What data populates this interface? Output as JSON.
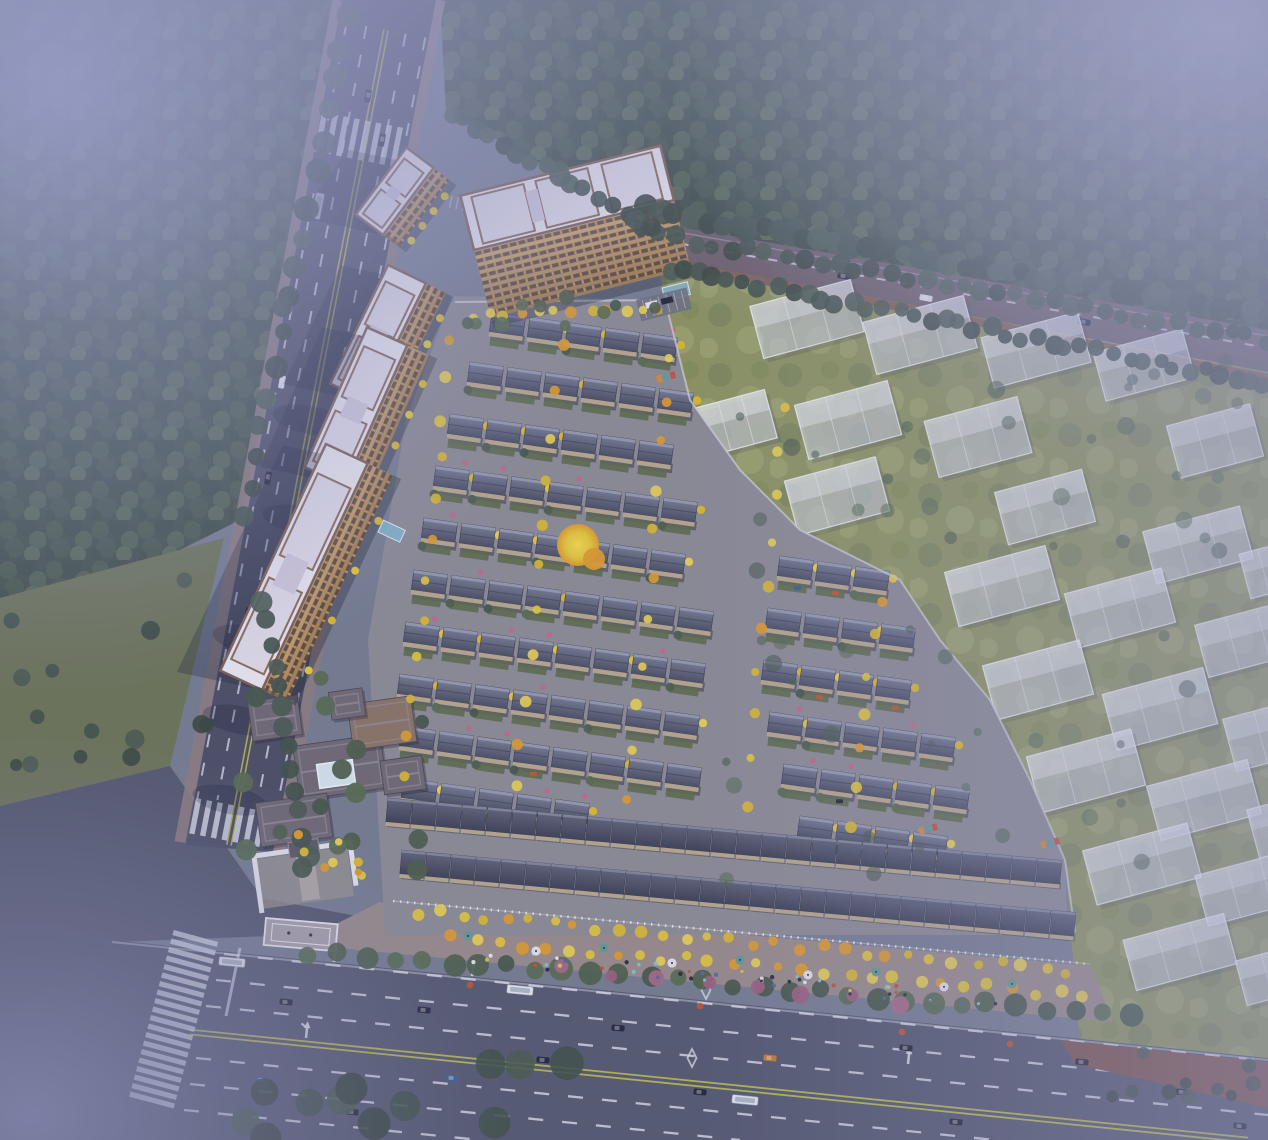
{
  "scene": {
    "type": "aerial-architectural-rendering",
    "description": "Dusk aerial rendering of a residential community: tan high-rise slabs along a western road, dark-roofed courtyard townhouse rows in the center, translucent future-phase villas on an eastern meadow, fog-covered forest, and a wide south boulevard with a shop-lined entrance promenade.",
    "canvas": {
      "width": 1268,
      "height": 1140
    },
    "palette": {
      "base": "#757c90",
      "haze_tl": "#9ba0c8",
      "haze_tr": "#a9adcf",
      "haze_bl": "#8488ad",
      "haze_r": "#9a9ec4",
      "tint": "#6d74a8",
      "forest_bg": "#3f4c44",
      "forest_1": "#475848",
      "forest_2": "#3a4a42",
      "forest_3": "#4e5f4e",
      "forest_4": "#435447",
      "forest_5": "#556653",
      "meadow_bg": "#8d935f",
      "meadow_1": "#7e885a",
      "meadow_2": "#99a06a",
      "meadow_3": "#848e57",
      "lawn": "#6b7356",
      "plaza": "#53566c",
      "asphalt_w": "#4b4e64",
      "asphalt_s": "#54586f",
      "asphalt_n": "#6b5e68",
      "lane_white": "#d6d9e6",
      "lane_yellow": "#b9b94f",
      "sidewalk": "#8d7b7e",
      "sidewalk_warm": "#978a8a",
      "median_brown": "#7b5450",
      "villa_roof_hi": "#777c93",
      "villa_roof_lo": "#4a4e63",
      "villa_ridge": "#959ab0",
      "villa_wall": "#b7a68b",
      "garden": "#5c6a4b",
      "shop_roof_hi": "#60647a",
      "shop_roof_lo": "#3d4155",
      "shop_ridge": "#80859a",
      "path": "#8b8a94",
      "tower_roof": "#e9e7f0",
      "tower_panel": "#dfdbe8",
      "tower_trim": "#7c5f53",
      "tower_wall_hi": "#d0a873",
      "tower_wall_lo": "#9c7950",
      "window_dark": "#4a3c35",
      "window_mullion": "#bb9161",
      "ghost_fill": "rgba(226,230,242,0.52)",
      "ghost_line": "rgba(244,246,252,0.8)",
      "ghost_roof": "rgba(250,251,255,0.35)",
      "club_roof": "#6e6874",
      "club_roof_warm": "#8a7366",
      "club_ridge": "#908b96",
      "skylight": "#d3e2ec",
      "white_wall": "#e6e6ec",
      "ginkgo": "#e2c63b",
      "ginkgo_2": "#d9b82f",
      "ginkgo_3": "#e7cf52",
      "ginkgo_orange": "#dd9b2d",
      "tree_g1": "#4d5e4c",
      "tree_g2": "#576a51",
      "tree_g3": "#45564a",
      "tree_d1": "#41514a",
      "tree_d2": "#38463f",
      "tree_d3": "#4a5a50",
      "blossom": "#a66a88",
      "flower_pink": "#c96487",
      "flower_red": "#c05532",
      "umbrella": "#5e9b97",
      "glass": "#82b4c9",
      "car_dark": "#23263a",
      "car_white": "#e3e5ee",
      "car_blue": "#3c5f92",
      "car_orange": "#c27a2e",
      "shadow": "rgba(28,32,56,0.3)"
    },
    "forest_nw": [
      [
        0,
        0
      ],
      [
        346,
        0
      ],
      [
        288,
        300
      ],
      [
        240,
        520
      ],
      [
        0,
        640
      ]
    ],
    "forest_ne": [
      [
        440,
        0
      ],
      [
        1268,
        0
      ],
      [
        1268,
        332
      ],
      [
        658,
        228
      ],
      [
        446,
        112
      ]
    ],
    "lawn_west": [
      [
        0,
        598
      ],
      [
        224,
        538
      ],
      [
        170,
        766
      ],
      [
        0,
        806
      ]
    ],
    "meadow_east": [
      [
        655,
        250
      ],
      [
        1268,
        360
      ],
      [
        1268,
        1062
      ],
      [
        1080,
        1044
      ],
      [
        1065,
        860
      ],
      [
        1030,
        780
      ],
      [
        990,
        700
      ],
      [
        940,
        640
      ],
      [
        900,
        580
      ],
      [
        800,
        530
      ],
      [
        740,
        470
      ],
      [
        690,
        400
      ],
      [
        665,
        300
      ]
    ],
    "plaza": [
      [
        0,
        806
      ],
      [
        170,
        766
      ],
      [
        262,
        898
      ],
      [
        430,
        930
      ],
      [
        114,
        942
      ],
      [
        0,
        1016
      ]
    ],
    "villa_ground": [
      [
        452,
        296
      ],
      [
        665,
        300
      ],
      [
        690,
        400
      ],
      [
        740,
        470
      ],
      [
        800,
        530
      ],
      [
        900,
        580
      ],
      [
        940,
        640
      ],
      [
        990,
        700
      ],
      [
        1030,
        780
      ],
      [
        1065,
        860
      ],
      [
        1068,
        935
      ],
      [
        385,
        935
      ],
      [
        368,
        640
      ],
      [
        406,
        420
      ]
    ],
    "sidewalk_south": [
      [
        380,
        902
      ],
      [
        1092,
        966
      ],
      [
        1112,
        1022
      ],
      [
        296,
        944
      ]
    ],
    "median_verge": [
      [
        1060,
        1040
      ],
      [
        1268,
        1062
      ],
      [
        1268,
        1108
      ],
      [
        1075,
        1064
      ]
    ],
    "road_west_poly": [
      [
        342,
        0
      ],
      [
        436,
        0
      ],
      [
        273,
        852
      ],
      [
        186,
        845
      ]
    ],
    "road_west_center": [
      386,
      30,
      229,
      845
    ],
    "road_north_poly": [
      [
        652,
        222
      ],
      [
        1268,
        330
      ],
      [
        1268,
        372
      ],
      [
        662,
        258
      ]
    ],
    "road_south_poly": [
      [
        112,
        940
      ],
      [
        1268,
        1058
      ],
      [
        1268,
        1140
      ],
      [
        0,
        1140
      ],
      [
        0,
        1016
      ]
    ],
    "yellow_line_south": [
      190,
      1032,
      1248,
      1140
    ],
    "boundary_wall": [
      [
        455,
        302
      ],
      [
        665,
        300
      ],
      [
        690,
        400
      ],
      [
        740,
        470
      ],
      [
        800,
        530
      ],
      [
        900,
        580
      ],
      [
        940,
        640
      ],
      [
        990,
        700
      ],
      [
        1030,
        780
      ],
      [
        1065,
        860
      ],
      [
        1075,
        932
      ]
    ],
    "towers": [
      [
        383,
        235,
        84,
        34,
        20,
        -53
      ],
      [
        368,
        402,
        132,
        42,
        22,
        -64
      ],
      [
        345,
        485,
        153,
        44,
        24,
        -66
      ],
      [
        262,
        690,
        250,
        46,
        28,
        -65
      ]
    ],
    "slab": {
      "x": 474,
      "y": 250,
      "len": 206,
      "w": 56,
      "fw": 70,
      "rot": -14
    },
    "villa_rows": [
      [
        492,
        312,
        5
      ],
      [
        470,
        362,
        6
      ],
      [
        450,
        414,
        6
      ],
      [
        436,
        466,
        7
      ],
      [
        424,
        518,
        7
      ],
      [
        414,
        570,
        8
      ],
      [
        406,
        622,
        8
      ],
      [
        400,
        674,
        8
      ],
      [
        402,
        726,
        8
      ],
      [
        404,
        778,
        5
      ]
    ],
    "annex_rows": [
      [
        780,
        556,
        3
      ],
      [
        768,
        608,
        4
      ],
      [
        764,
        660,
        4
      ],
      [
        770,
        712,
        5
      ],
      [
        784,
        764,
        5
      ],
      [
        800,
        816,
        4
      ]
    ],
    "shop_bands": [
      [
        388,
        798,
        27
      ],
      [
        402,
        850,
        27
      ]
    ],
    "ghost_blocks": [
      [
        755,
        292,
        104,
        54
      ],
      [
        868,
        308,
        104,
        54
      ],
      [
        986,
        324,
        100,
        52
      ],
      [
        1098,
        340,
        92,
        50
      ],
      [
        700,
        398,
        72,
        50
      ],
      [
        800,
        392,
        96,
        56
      ],
      [
        930,
        408,
        96,
        58
      ],
      [
        1172,
        414,
        86,
        54
      ],
      [
        790,
        468,
        94,
        56
      ],
      [
        1000,
        480,
        90,
        54
      ],
      [
        1148,
        518,
        100,
        54
      ],
      [
        1244,
        546,
        58,
        46
      ],
      [
        950,
        558,
        104,
        56
      ],
      [
        1070,
        580,
        100,
        56
      ],
      [
        1200,
        612,
        96,
        54
      ],
      [
        988,
        652,
        100,
        56
      ],
      [
        1108,
        680,
        104,
        58
      ],
      [
        1228,
        706,
        96,
        54
      ],
      [
        1032,
        742,
        108,
        58
      ],
      [
        1152,
        772,
        104,
        56
      ],
      [
        1252,
        800,
        70,
        50
      ],
      [
        1088,
        836,
        108,
        56
      ],
      [
        1200,
        862,
        100,
        52
      ],
      [
        1128,
        926,
        104,
        52
      ],
      [
        1240,
        950,
        80,
        46
      ]
    ],
    "club_roofs": [
      [
        296,
        740,
        88,
        54,
        "club_roof"
      ],
      [
        250,
        698,
        50,
        40,
        "club_roof"
      ],
      [
        350,
        700,
        64,
        46,
        "club_roof_warm"
      ],
      [
        258,
        798,
        72,
        44,
        "club_roof"
      ],
      [
        382,
        758,
        42,
        34,
        "club_roof"
      ],
      [
        330,
        690,
        34,
        28,
        "club_roof"
      ]
    ],
    "skylight_rect": [
      318,
      762,
      36,
      24
    ],
    "tree_lines": [
      [
        648,
        210,
        1266,
        316,
        44,
        8,
        13,
        "d"
      ],
      [
        642,
        232,
        1266,
        340,
        36,
        7,
        10,
        "d"
      ],
      [
        668,
        268,
        1266,
        384,
        40,
        7,
        10,
        "d"
      ],
      [
        450,
        112,
        652,
        230,
        16,
        8,
        12,
        "d"
      ],
      [
        348,
        16,
        288,
        300,
        10,
        9,
        13,
        "d"
      ],
      [
        286,
        304,
        243,
        520,
        8,
        8,
        12,
        "d"
      ],
      [
        262,
        600,
        308,
        856,
        13,
        8,
        11,
        "d"
      ],
      [
        470,
        318,
        658,
        306,
        12,
        4,
        6,
        "y"
      ],
      [
        452,
        340,
        404,
        778,
        12,
        4,
        6,
        "y"
      ],
      [
        560,
        348,
        516,
        788,
        11,
        4,
        6,
        "y"
      ],
      [
        672,
        356,
        628,
        796,
        11,
        4,
        6,
        "y"
      ],
      [
        784,
        406,
        744,
        806,
        10,
        4,
        6,
        "y"
      ],
      [
        880,
        600,
        850,
        826,
        7,
        4,
        6,
        "y"
      ],
      [
        420,
        912,
        1066,
        971,
        30,
        4,
        6.5,
        "y"
      ],
      [
        452,
        938,
        1082,
        996,
        28,
        4,
        6.5,
        "y"
      ],
      [
        310,
        952,
        1130,
        1016,
        30,
        8,
        12,
        "g"
      ],
      [
        560,
        970,
        900,
        1002,
        8,
        6,
        9,
        "p"
      ]
    ],
    "scatters": [
      [
        720,
        360,
        530,
        560,
        55,
        4,
        9,
        "g",
        0.55
      ],
      [
        10,
        560,
        200,
        220,
        14,
        6,
        10,
        "d",
        0.9
      ],
      [
        240,
        1030,
        330,
        110,
        12,
        13,
        20,
        "d",
        0.9
      ],
      [
        238,
        676,
        200,
        200,
        16,
        7,
        11,
        "g",
        0.95
      ],
      [
        292,
        826,
        70,
        54,
        8,
        3.5,
        5,
        "y",
        1
      ],
      [
        436,
        296,
        240,
        30,
        10,
        5,
        8,
        "g",
        0.9
      ],
      [
        1080,
        1050,
        180,
        50,
        10,
        5,
        8,
        "d",
        0.85
      ]
    ],
    "feature_tree": [
      578,
      545,
      21
    ],
    "glass_canopies": [
      [
        378,
        532,
        13,
        24,
        -65
      ],
      [
        662,
        288,
        26,
        13,
        -14
      ]
    ],
    "playgrounds": [
      [
        918,
        828
      ],
      [
        1040,
        842
      ],
      [
        656,
        376
      ]
    ],
    "cars": {
      "west": [
        [
          368,
          96,
          "car_dark"
        ],
        [
          382,
          140,
          "car_dark"
        ],
        [
          318,
          206,
          "bus"
        ],
        [
          282,
          382,
          "car_white"
        ],
        [
          268,
          478,
          "car_dark"
        ],
        [
          306,
          540,
          "car_dark"
        ],
        [
          248,
          614,
          "car_dark"
        ]
      ],
      "north": [
        [
          844,
          276,
          "car_dark"
        ],
        [
          926,
          298,
          "car_white"
        ],
        [
          1084,
          322,
          "car_dark"
        ]
      ],
      "south": [
        [
          286,
          1002,
          "car_dark"
        ],
        [
          424,
          1010,
          "car_dark"
        ],
        [
          543,
          1060,
          "car_dark"
        ],
        [
          352,
          1112,
          "car_dark"
        ],
        [
          262,
          1080,
          "car_blue"
        ],
        [
          700,
          1092,
          "car_dark"
        ],
        [
          906,
          1048,
          "car_dark"
        ],
        [
          1082,
          1062,
          "car_dark"
        ],
        [
          1182,
          1092,
          "car_dark"
        ],
        [
          1240,
          1126,
          "car_dark"
        ],
        [
          452,
          1078,
          "car_blue"
        ],
        [
          956,
          1122,
          "car_dark"
        ],
        [
          770,
          1058,
          "car_orange"
        ],
        [
          618,
          1028,
          "car_dark"
        ]
      ],
      "buses_south": [
        [
          232,
          962
        ],
        [
          520,
          990
        ],
        [
          745,
          1100
        ]
      ]
    },
    "counts": {
      "people": 48,
      "umbrellas": 9,
      "zebra_bars": 20
    }
  }
}
